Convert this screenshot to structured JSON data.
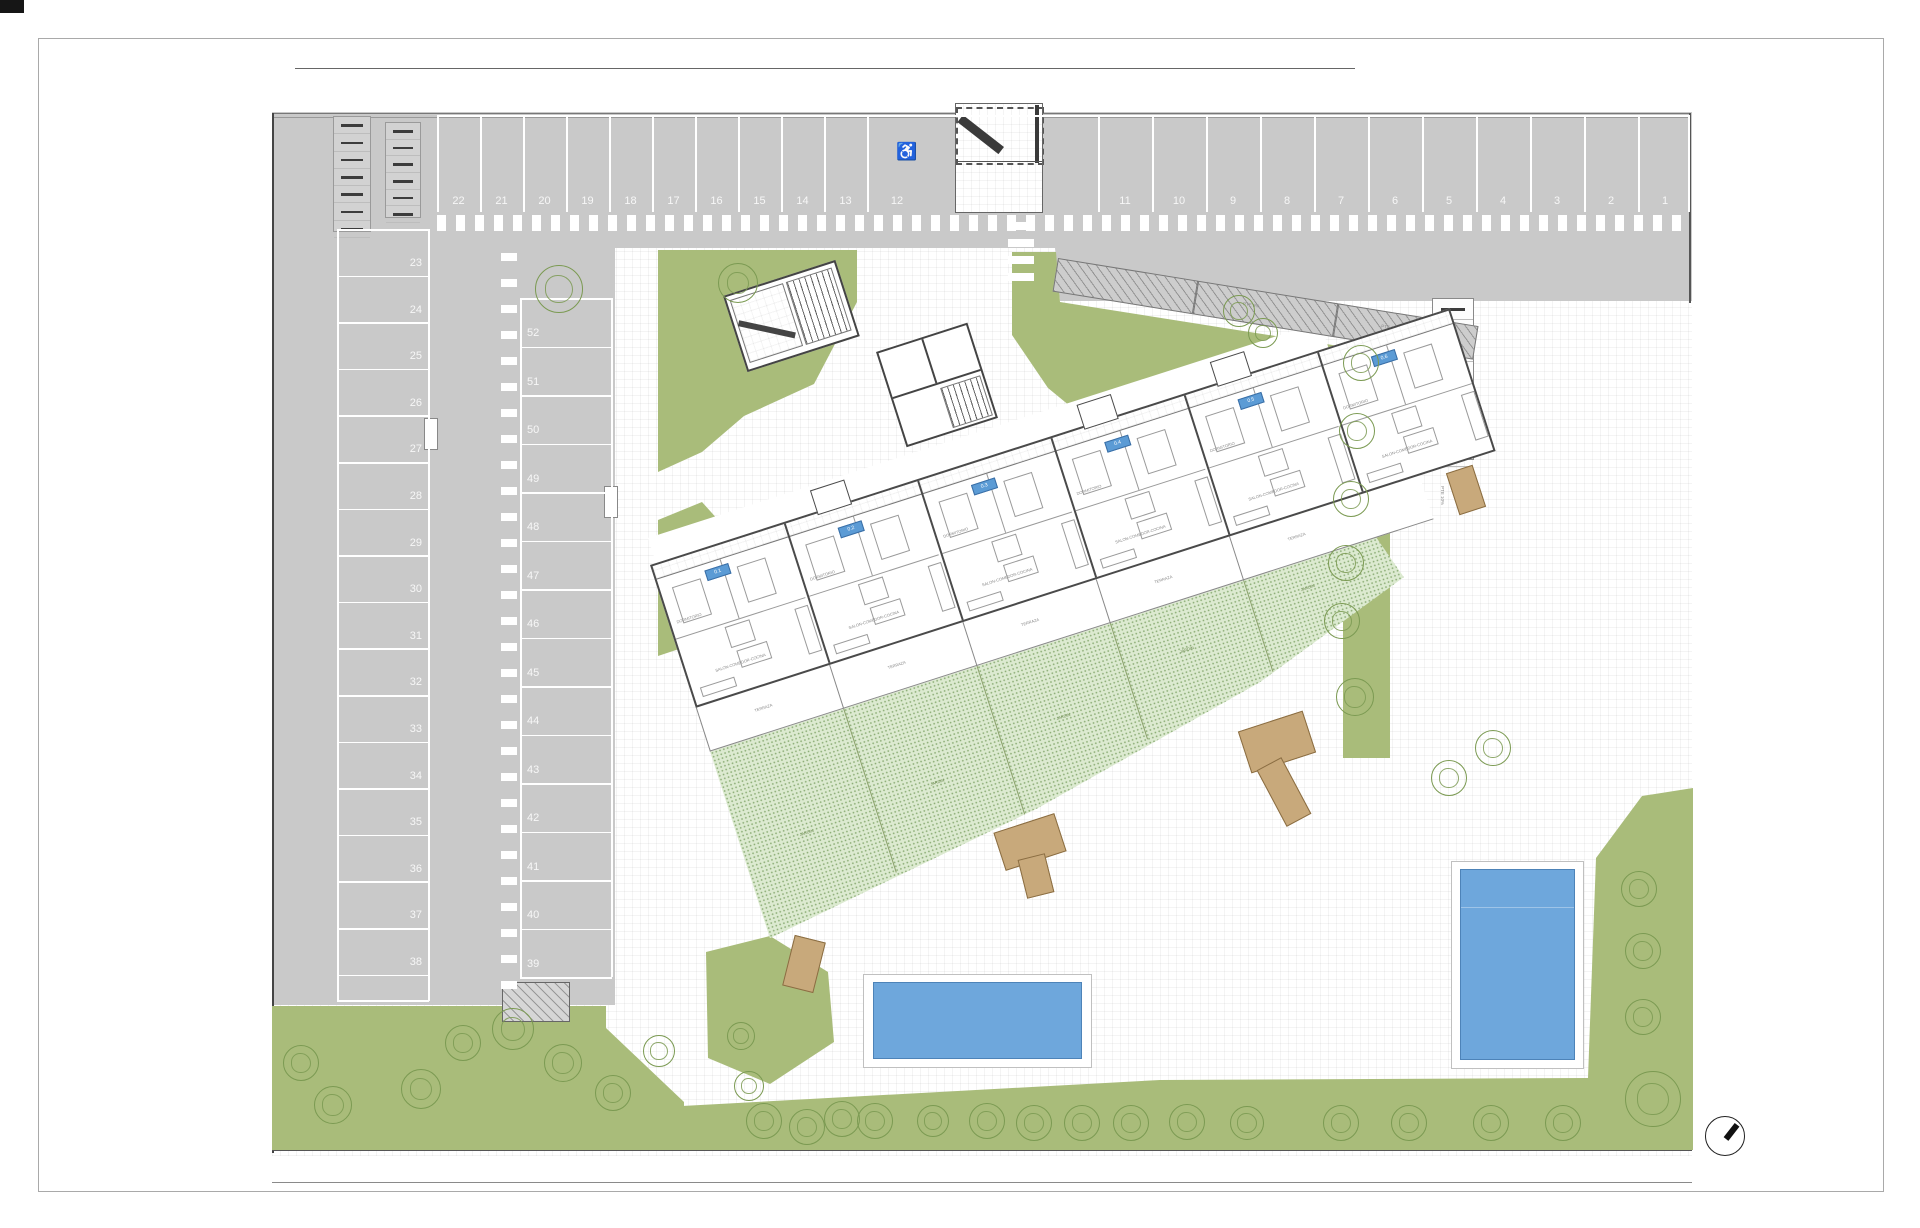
{
  "title": "residential site plan",
  "colors": {
    "parking_gray": "#c9c9c9",
    "lawn_green": "#a9bc7a",
    "garden_stipple": "#dcead0",
    "pool_blue": "#6ea7dc",
    "deck_tan": "#c8a97b",
    "wall_dark": "#4a4a4a",
    "unit_tag_blue": "#5b9bd5"
  },
  "parking": {
    "top_row_left_numbers": [
      "22",
      "21",
      "20",
      "19",
      "18",
      "17",
      "16",
      "15",
      "14",
      "13"
    ],
    "handicap_number": "12",
    "handicap_icon": "wheelchair",
    "top_row_right_numbers": [
      "11",
      "10",
      "9",
      "8",
      "7",
      "6",
      "5",
      "4",
      "3",
      "2",
      "1"
    ],
    "left_column_numbers": [
      "23",
      "24",
      "25",
      "26",
      "27",
      "28",
      "29",
      "30",
      "31",
      "32",
      "33",
      "34",
      "35",
      "36",
      "37",
      "38"
    ],
    "middle_column_numbers": [
      "52",
      "51",
      "50",
      "49",
      "48",
      "47",
      "46",
      "45",
      "44",
      "43",
      "42",
      "41",
      "40",
      "39"
    ]
  },
  "ramps": {
    "ne_ramp_labels": [
      "PTE 8%",
      "PTE 8%"
    ],
    "east_ramp_label": "PTE 10%"
  },
  "building": {
    "units": [
      {
        "tag": "0.1"
      },
      {
        "tag": "0.2"
      },
      {
        "tag": "0.3"
      },
      {
        "tag": "0.4"
      },
      {
        "tag": "0.5"
      },
      {
        "tag": "0.6"
      }
    ],
    "room_labels": {
      "bedroom": "DORMITORIO",
      "living": "SALON-COMEDOR-COCINA",
      "terrace": "TERRAZA",
      "garden": "JARDIN"
    }
  },
  "garden_label_spots": [
    [
      60,
      300
    ],
    [
      200,
      292
    ],
    [
      340,
      268
    ],
    [
      478,
      242
    ],
    [
      612,
      220
    ]
  ],
  "trees": [
    [
      558,
      288,
      46
    ],
    [
      737,
      282,
      38
    ],
    [
      1238,
      310,
      30
    ],
    [
      1262,
      332,
      28
    ],
    [
      1360,
      362,
      34
    ],
    [
      1356,
      430,
      34
    ],
    [
      1350,
      498,
      34
    ],
    [
      1345,
      562,
      34
    ],
    [
      1341,
      620,
      34
    ],
    [
      1354,
      696,
      36
    ],
    [
      1448,
      777,
      34
    ],
    [
      1492,
      747,
      34
    ],
    [
      1638,
      888,
      34
    ],
    [
      1642,
      950,
      34
    ],
    [
      1642,
      1016,
      34
    ],
    [
      1652,
      1098,
      54
    ],
    [
      763,
      1120,
      34
    ],
    [
      806,
      1126,
      34
    ],
    [
      841,
      1118,
      34
    ],
    [
      874,
      1120,
      34
    ],
    [
      932,
      1120,
      30
    ],
    [
      986,
      1120,
      34
    ],
    [
      1033,
      1122,
      34
    ],
    [
      1081,
      1122,
      34
    ],
    [
      1130,
      1122,
      34
    ],
    [
      1186,
      1121,
      34
    ],
    [
      1246,
      1122,
      32
    ],
    [
      1340,
      1122,
      34
    ],
    [
      1408,
      1122,
      34
    ],
    [
      1490,
      1122,
      34
    ],
    [
      1562,
      1122,
      34
    ],
    [
      300,
      1062,
      34
    ],
    [
      332,
      1104,
      36
    ],
    [
      420,
      1088,
      38
    ],
    [
      462,
      1042,
      34
    ],
    [
      512,
      1028,
      40
    ],
    [
      562,
      1062,
      36
    ],
    [
      612,
      1092,
      34
    ],
    [
      658,
      1050,
      30
    ],
    [
      740,
      1035,
      26
    ],
    [
      748,
      1085,
      28
    ]
  ],
  "compass": {
    "name": "north-arrow"
  }
}
